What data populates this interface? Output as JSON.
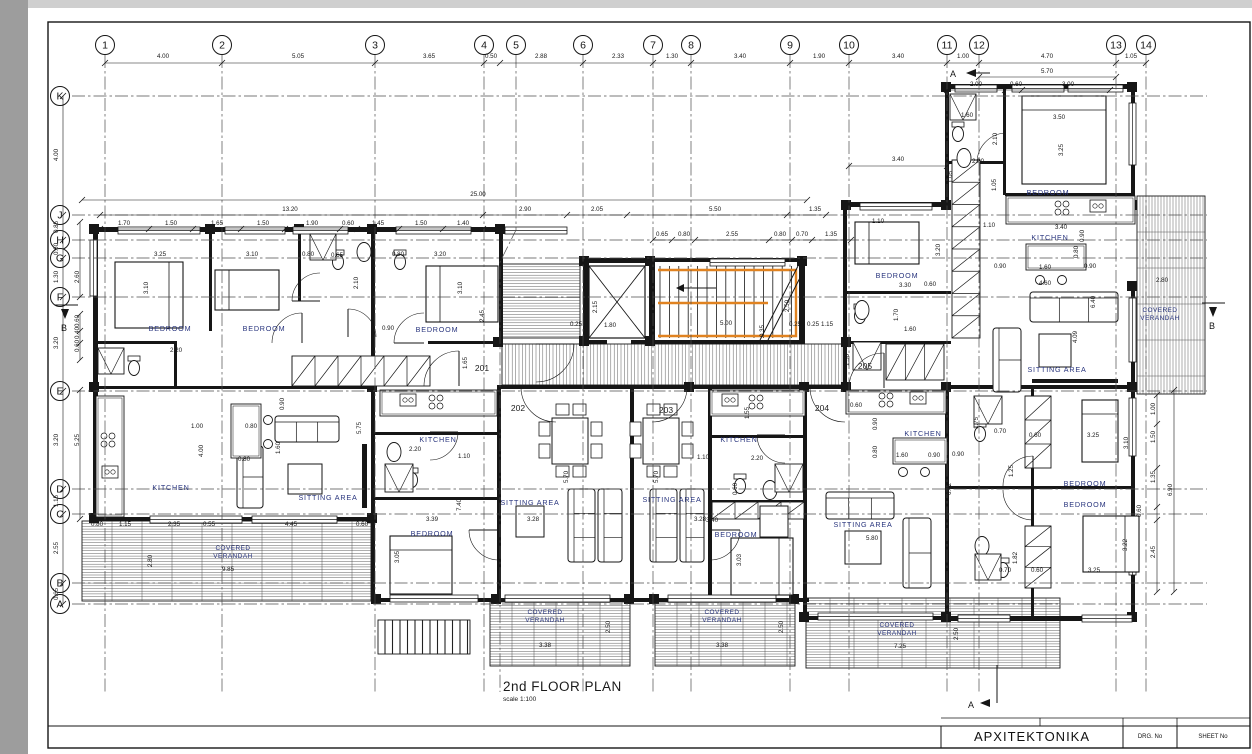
{
  "title": {
    "main": "2nd FLOOR PLAN",
    "scale": "scale 1:100"
  },
  "title_block": {
    "discipline": "ΑΡΧΙΤΕΚΤΟΝΙΚΑ",
    "drg_no_label": "DRG. No",
    "sheet_no_label": "SHEET No"
  },
  "colors": {
    "ink": "#161616",
    "room_label": "#28347d",
    "stair_highlight": "#e08220",
    "grid_line": "#4c4c4c",
    "paper": "#ffffff"
  },
  "grid": {
    "columns": [
      {
        "label": "1",
        "x": 105
      },
      {
        "label": "2",
        "x": 222
      },
      {
        "label": "3",
        "x": 375
      },
      {
        "label": "4",
        "x": 484
      },
      {
        "label": "5",
        "x": 516
      },
      {
        "label": "6",
        "x": 583
      },
      {
        "label": "7",
        "x": 653
      },
      {
        "label": "8",
        "x": 691
      },
      {
        "label": "9",
        "x": 790
      },
      {
        "label": "10",
        "x": 849
      },
      {
        "label": "11",
        "x": 947
      },
      {
        "label": "12",
        "x": 979
      },
      {
        "label": "13",
        "x": 1116
      },
      {
        "label": "14",
        "x": 1146
      }
    ],
    "rows": [
      {
        "label": "K",
        "y": 96
      },
      {
        "label": "J",
        "y": 215
      },
      {
        "label": "H",
        "y": 240
      },
      {
        "label": "G",
        "y": 258
      },
      {
        "label": "F",
        "y": 297
      },
      {
        "label": "E",
        "y": 391
      },
      {
        "label": "D",
        "y": 489
      },
      {
        "label": "C",
        "y": 514
      },
      {
        "label": "B",
        "y": 583
      },
      {
        "label": "A",
        "y": 604
      }
    ]
  },
  "units": [
    [
      "201",
      482,
      371
    ],
    [
      "202",
      518,
      411
    ],
    [
      "203",
      666,
      413
    ],
    [
      "204",
      822,
      411
    ],
    [
      "205",
      865,
      369
    ]
  ],
  "rooms": [
    [
      "BEDROOM",
      170,
      331
    ],
    [
      "BEDROOM",
      264,
      331
    ],
    [
      "BEDROOM",
      437,
      332
    ],
    [
      "BEDROOM",
      432,
      536
    ],
    [
      "BEDROOM",
      736,
      537
    ],
    [
      "BEDROOM",
      897,
      278
    ],
    [
      "BEDROOM",
      1048,
      195
    ],
    [
      "BEDROOM",
      1085,
      486
    ],
    [
      "BEDROOM",
      1085,
      507
    ],
    [
      "KITCHEN",
      171,
      490
    ],
    [
      "KITCHEN",
      438,
      442
    ],
    [
      "KITCHEN",
      739,
      442
    ],
    [
      "KITCHEN",
      923,
      436
    ],
    [
      "KITCHEN",
      1050,
      240
    ],
    [
      "SITTING AREA",
      328,
      500
    ],
    [
      "SITTING AREA",
      530,
      505
    ],
    [
      "SITTING AREA",
      672,
      502
    ],
    [
      "SITTING AREA",
      863,
      527
    ],
    [
      "SITTING AREA",
      1057,
      372
    ]
  ],
  "verandah": {
    "line1": "COVERED",
    "line2": "VERANDAH",
    "positions": [
      [
        233,
        550
      ],
      [
        545,
        614
      ],
      [
        722,
        614
      ],
      [
        897,
        627
      ],
      [
        1160,
        312
      ]
    ]
  },
  "sections": [
    [
      "A",
      953,
      77
    ],
    [
      "A",
      971,
      708
    ],
    [
      "B",
      64,
      331
    ],
    [
      "B",
      1212,
      329
    ]
  ],
  "dimensions": [
    [
      "4.00",
      163,
      58
    ],
    [
      "5.05",
      298,
      58
    ],
    [
      "3.65",
      429,
      58
    ],
    [
      "0.50",
      491,
      58
    ],
    [
      "2.88",
      541,
      58
    ],
    [
      "2.33",
      618,
      58
    ],
    [
      "1.30",
      672,
      58
    ],
    [
      "3.40",
      740,
      58
    ],
    [
      "1.90",
      819,
      58
    ],
    [
      "3.40",
      898,
      58
    ],
    [
      "1.00",
      963,
      58
    ],
    [
      "4.70",
      1047,
      58
    ],
    [
      "1.05",
      1131,
      58
    ],
    [
      "5.70",
      1047,
      73
    ],
    [
      "2.00",
      976,
      86
    ],
    [
      "0.60",
      1016,
      86
    ],
    [
      "3.00",
      1068,
      86
    ],
    [
      "3.40",
      898,
      161
    ],
    [
      "25.00",
      478,
      196
    ],
    [
      "13.20",
      290,
      211
    ],
    [
      "2.90",
      525,
      211
    ],
    [
      "2.05",
      597,
      211
    ],
    [
      "5.50",
      715,
      211
    ],
    [
      "1.35",
      815,
      211
    ],
    [
      "1.70",
      124,
      225
    ],
    [
      "1.50",
      171,
      225
    ],
    [
      "1.65",
      217,
      225
    ],
    [
      "1.50",
      263,
      225
    ],
    [
      "1.90",
      312,
      225
    ],
    [
      "0.60",
      348,
      225
    ],
    [
      "1.45",
      378,
      225
    ],
    [
      "1.50",
      421,
      225
    ],
    [
      "1.40",
      463,
      225
    ],
    [
      "0.65",
      662,
      236
    ],
    [
      "0.80",
      684,
      236
    ],
    [
      "2.55",
      732,
      236
    ],
    [
      "0.80",
      780,
      236
    ],
    [
      "0.70",
      802,
      236
    ],
    [
      "1.35",
      831,
      236
    ],
    [
      "4.00",
      58,
      155,
      1
    ],
    [
      "0.85",
      58,
      227,
      1
    ],
    [
      "0.60",
      58,
      249,
      1
    ],
    [
      "1.30",
      58,
      277,
      1
    ],
    [
      "3.20",
      58,
      343,
      1
    ],
    [
      "3.20",
      58,
      440,
      1
    ],
    [
      "1.15",
      58,
      501,
      1
    ],
    [
      "2.55",
      58,
      548,
      1
    ],
    [
      "0.65",
      58,
      594,
      1
    ],
    [
      "2.60",
      79,
      277,
      1
    ],
    [
      "0.60",
      79,
      321,
      1
    ],
    [
      "0.40",
      79,
      333,
      1
    ],
    [
      "0.60",
      79,
      346,
      1
    ],
    [
      "5.25",
      79,
      440,
      1
    ],
    [
      "1.00",
      1155,
      409,
      1
    ],
    [
      "1.50",
      1155,
      437,
      1
    ],
    [
      "1.35",
      1155,
      477,
      1
    ],
    [
      "2.45",
      1155,
      552,
      1
    ],
    [
      "6.90",
      1172,
      490,
      1
    ],
    [
      "0.60",
      1141,
      511,
      1
    ],
    [
      "3.25",
      160,
      256
    ],
    [
      "3.10",
      252,
      256
    ],
    [
      "3.10",
      148,
      288,
      1
    ],
    [
      "0.80",
      308,
      256
    ],
    [
      "0.65",
      337,
      257
    ],
    [
      "2.10",
      358,
      283,
      1
    ],
    [
      "0.80",
      398,
      256
    ],
    [
      "3.20",
      440,
      256
    ],
    [
      "3.10",
      462,
      288,
      1
    ],
    [
      "0.90",
      388,
      330
    ],
    [
      "2.20",
      176,
      352
    ],
    [
      "0.90",
      284,
      404,
      1
    ],
    [
      "1.00",
      197,
      428
    ],
    [
      "0.80",
      251,
      428
    ],
    [
      "4.00",
      203,
      451,
      1
    ],
    [
      "1.60",
      280,
      448,
      1
    ],
    [
      "5.75",
      361,
      428,
      1
    ],
    [
      "0.80",
      244,
      461
    ],
    [
      "0.80",
      97,
      526
    ],
    [
      "1.15",
      125,
      526
    ],
    [
      "2.35",
      174,
      526
    ],
    [
      "0.55",
      209,
      526
    ],
    [
      "4.45",
      291,
      526
    ],
    [
      "0.60",
      362,
      526
    ],
    [
      "2.80",
      152,
      561,
      1
    ],
    [
      "9.85",
      228,
      571
    ],
    [
      "2.20",
      415,
      451
    ],
    [
      "1.10",
      464,
      458
    ],
    [
      "1.65",
      467,
      363,
      1
    ],
    [
      "2.45",
      484,
      316,
      1
    ],
    [
      "7.40",
      461,
      505,
      1
    ],
    [
      "3.39",
      432,
      521
    ],
    [
      "3.05",
      399,
      557,
      1
    ],
    [
      "5.70",
      568,
      477,
      1
    ],
    [
      "3.28",
      533,
      521
    ],
    [
      "5.70",
      658,
      477,
      1
    ],
    [
      "3.28",
      700,
      521
    ],
    [
      "3.38",
      545,
      647
    ],
    [
      "3.38",
      722,
      647
    ],
    [
      "2.50",
      610,
      627,
      1
    ],
    [
      "2.50",
      783,
      627,
      1
    ],
    [
      "2.15",
      597,
      307,
      1
    ],
    [
      "1.80",
      610,
      327
    ],
    [
      "0.25",
      576,
      326
    ],
    [
      "5.00",
      726,
      325
    ],
    [
      "0.35",
      764,
      331,
      1
    ],
    [
      "2.50",
      789,
      306,
      1
    ],
    [
      "0.25",
      795,
      326
    ],
    [
      "0.25",
      813,
      326
    ],
    [
      "1.15",
      827,
      326
    ],
    [
      "1.50",
      849,
      360,
      1
    ],
    [
      "1.55",
      749,
      413,
      1
    ],
    [
      "1.10",
      703,
      459
    ],
    [
      "2.20",
      757,
      460
    ],
    [
      "0.60",
      737,
      489,
      1
    ],
    [
      "3.40",
      712,
      522
    ],
    [
      "3.03",
      741,
      560,
      1
    ],
    [
      "0.60",
      856,
      407
    ],
    [
      "0.90",
      877,
      424,
      1
    ],
    [
      "0.80",
      877,
      452,
      1
    ],
    [
      "1.60",
      902,
      457
    ],
    [
      "0.90",
      934,
      457
    ],
    [
      "6.42",
      951,
      489,
      1
    ],
    [
      "5.80",
      872,
      540
    ],
    [
      "7.25",
      900,
      648
    ],
    [
      "2.50",
      958,
      634,
      1
    ],
    [
      "1.10",
      878,
      223
    ],
    [
      "3.20",
      940,
      250,
      1
    ],
    [
      "3.30",
      905,
      287
    ],
    [
      "0.60",
      930,
      286
    ],
    [
      "1.70",
      898,
      315,
      1
    ],
    [
      "1.60",
      910,
      331
    ],
    [
      "0.90",
      1000,
      268
    ],
    [
      "1.60",
      1045,
      269
    ],
    [
      "0.90",
      1090,
      268
    ],
    [
      "4.60",
      1045,
      285
    ],
    [
      "0.80",
      1078,
      252,
      1
    ],
    [
      "6.40",
      1095,
      302,
      1
    ],
    [
      "4.09",
      1077,
      337,
      1
    ],
    [
      "3.40",
      1061,
      229
    ],
    [
      "0.90",
      1084,
      236,
      1
    ],
    [
      "3.50",
      1059,
      119
    ],
    [
      "3.25",
      1063,
      150,
      1
    ],
    [
      "2.10",
      997,
      139,
      1
    ],
    [
      "2.00",
      978,
      163
    ],
    [
      "1.05",
      996,
      185,
      1
    ],
    [
      "1.10",
      989,
      227
    ],
    [
      "1.60",
      967,
      117
    ],
    [
      "2.80",
      1162,
      282
    ],
    [
      "1.05",
      952,
      177,
      1
    ],
    [
      "1.75",
      978,
      423,
      1
    ],
    [
      "0.70",
      1000,
      433
    ],
    [
      "0.60",
      1035,
      437
    ],
    [
      "3.25",
      1093,
      437
    ],
    [
      "3.10",
      1128,
      443,
      1
    ],
    [
      "1.25",
      1013,
      471,
      1
    ],
    [
      "0.90",
      958,
      456
    ],
    [
      "3.22",
      1127,
      545,
      1
    ],
    [
      "3.25",
      1094,
      572
    ],
    [
      "1.82",
      1017,
      558,
      1
    ],
    [
      "0.70",
      1005,
      572
    ],
    [
      "0.60",
      1037,
      572
    ]
  ]
}
